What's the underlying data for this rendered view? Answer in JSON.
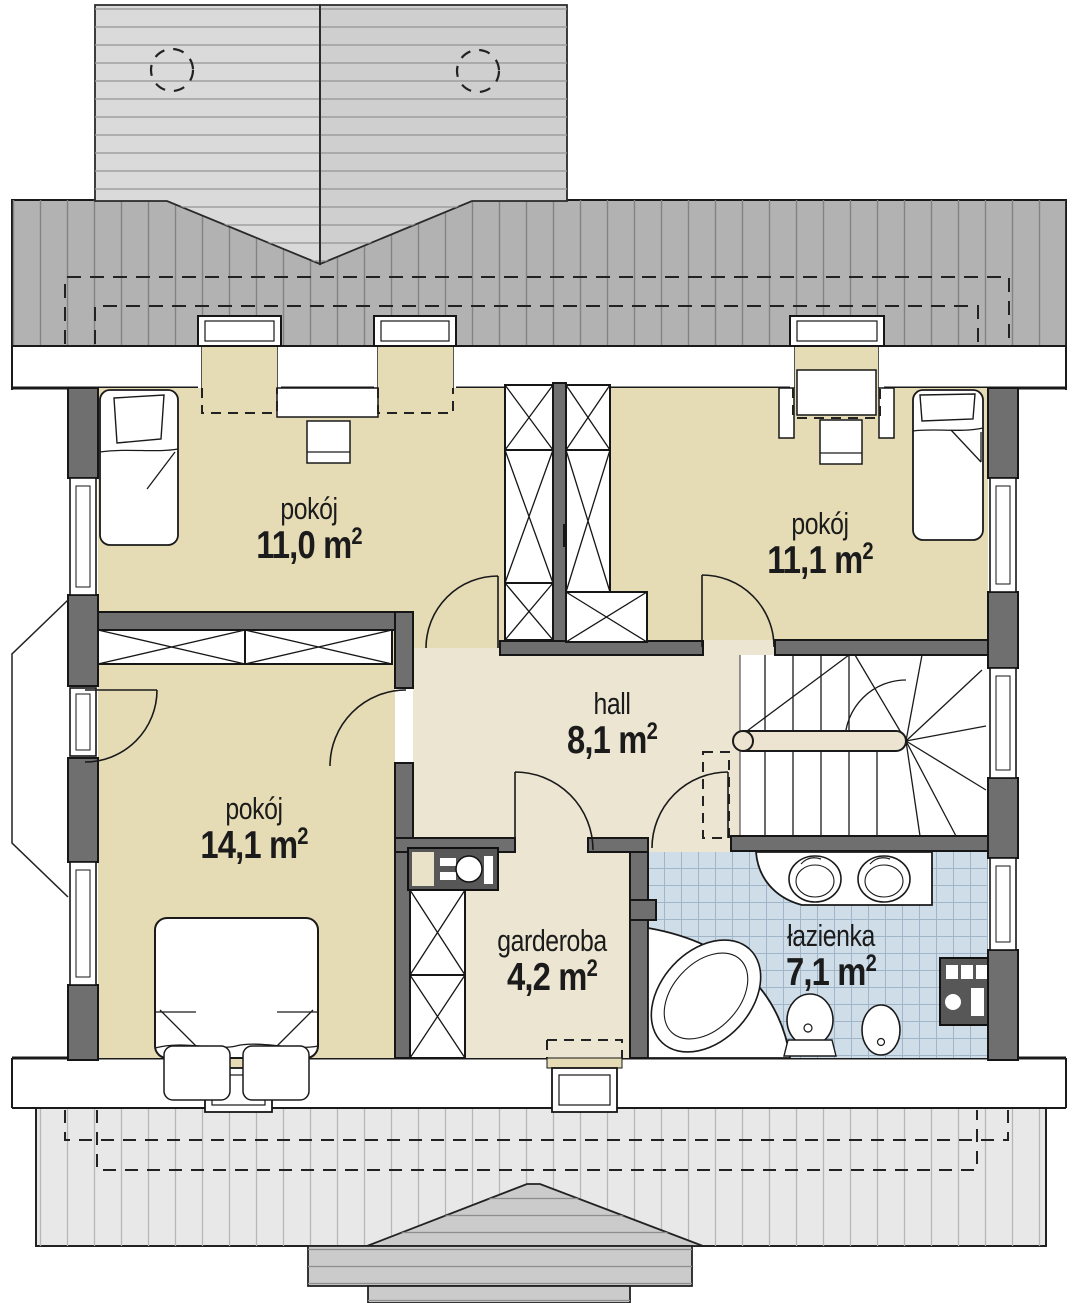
{
  "rooms": [
    {
      "id": "pokoj-11-0",
      "name": "pokój",
      "area": "11,0 m",
      "area_sup": "2"
    },
    {
      "id": "pokoj-11-1",
      "name": "pokój",
      "area": "11,1 m",
      "area_sup": "2"
    },
    {
      "id": "hall",
      "name": "hall",
      "area": "8,1 m",
      "area_sup": "2"
    },
    {
      "id": "pokoj-14-1",
      "name": "pokój",
      "area": "14,1 m",
      "area_sup": "2"
    },
    {
      "id": "garderoba",
      "name": "garderoba",
      "area": "4,2 m",
      "area_sup": "2"
    },
    {
      "id": "lazienka",
      "name": "łazienka",
      "area": "7,1 m",
      "area_sup": "2"
    }
  ],
  "palette": {
    "room_floor": "#e5dcb6",
    "hall_floor": "#ece5d2",
    "bathroom_tile": "#cedde8",
    "tile_grid": "#a0b6c8",
    "wall_dark": "#6f6f6f",
    "fixture_dark": "#575757",
    "roof_main": "#b2b2b2",
    "roof_dormer_light": "#dadada",
    "roof_dormer_mid": "#cfcfcf",
    "roof_bottom": "#e8e8e8",
    "roof_bottom_dormer": "#cbcbcb",
    "handrail": "#ece4d0",
    "line": "#1a1a1a"
  }
}
